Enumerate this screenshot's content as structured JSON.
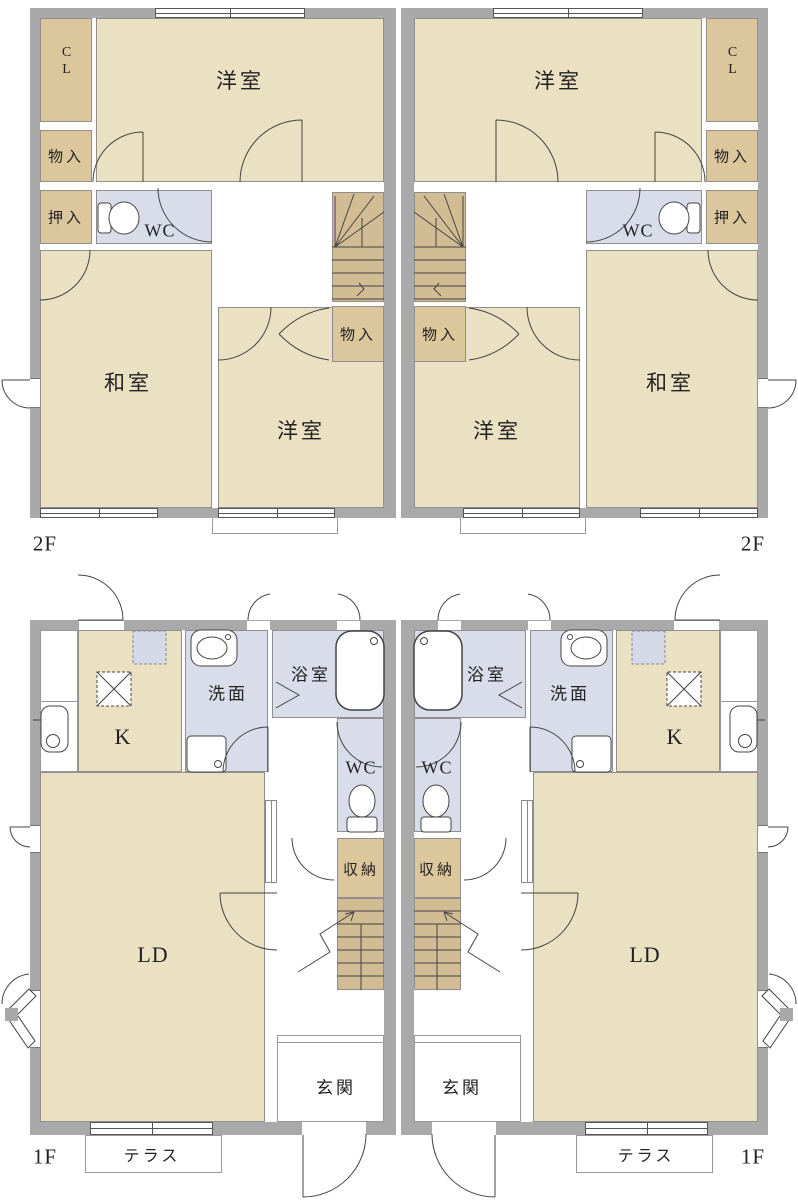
{
  "floor_plan": {
    "floors": [
      {
        "label": "2F"
      },
      {
        "label": "1F"
      }
    ],
    "rooms": {
      "western_room": "洋室",
      "japanese_room": "和室",
      "closet": "CL",
      "storage": "物入",
      "oshiire": "押入",
      "toilet": "WC",
      "washroom": "洗面",
      "bathroom": "浴室",
      "kitchen": "K",
      "living_dining": "LD",
      "stair_storage": "収納",
      "entrance": "玄関",
      "terrace": "テラス"
    },
    "colors": {
      "wall": "#a9a9a9",
      "room_beige": "#eae0c2",
      "closet_tan": "#dcc69c",
      "stair_tan": "#d2bc93",
      "wet_blue": "#d9dde9",
      "fixture_blue": "#d3d9e6",
      "line": "#444444",
      "border": "#8f8f8f",
      "text": "#222222"
    }
  }
}
